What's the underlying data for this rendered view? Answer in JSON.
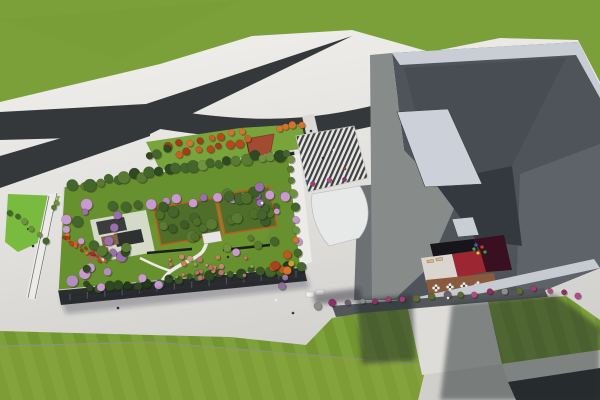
{
  "meta": {
    "type": "3d-architectural-aerial-rendering",
    "subject": "Aerial render of a campus: rooftop garden building, angular gray main building with sunken red courtyard terrace, forked asphalt roads, striped entrance plaza and striped lawns",
    "width": 600,
    "height": 400
  },
  "palette": {
    "pavement_light": "#f2f1ee",
    "pavement_dark": "#d3d2cf",
    "road_asphalt": "#35383a",
    "asphalt_dark": "#2a2d2f",
    "lawn_top": "#7ba03a",
    "lawn_stripe_a": "#7ea23a",
    "lawn_stripe_b": "#739631",
    "lawn_lower_tint": "#8ba33c",
    "bright_lawn": "#78bb3e",
    "garden_lawn": "#67902e",
    "north_strip_green": "#79a43c",
    "terracotta_plaza": "#a34a33",
    "corten_edge": "#c05a20",
    "building_parapet_light": "#c9cdd6",
    "building_wall_mid": "#878b8a",
    "building_wall_dark": "#4f545b",
    "building_fold": "#484d53",
    "building_overhang": "#343940",
    "skylight": "#ccd0d8",
    "courtyard_red": "#9c2732",
    "courtyard_maroon": "#381020",
    "deck_brown": "#8a5a3c",
    "shrub_magenta": "#a23a78",
    "blossom_purple": "#9b6fae",
    "autumn_orange": "#c2561f",
    "path_white": "#eceae6",
    "shadow": "#23282c"
  },
  "scene": {
    "vegetation": [
      {
        "name": "north-autumn-row-1",
        "layer": "back",
        "mode": "row",
        "a": [
          168,
          146
        ],
        "b": [
          244,
          131
        ],
        "count": 8,
        "rmin": 3,
        "rmax": 4.5,
        "jitter": 2,
        "colors": [
          "#b5491d",
          "#c95f24",
          "#a8391a",
          "#d2742d"
        ]
      },
      {
        "name": "north-autumn-row-2",
        "layer": "back",
        "mode": "row",
        "a": [
          178,
          155
        ],
        "b": [
          250,
          140
        ],
        "count": 8,
        "rmin": 3,
        "rmax": 4.5,
        "jitter": 2,
        "colors": [
          "#b5491d",
          "#c95f24",
          "#a8391a",
          "#d2742d"
        ]
      },
      {
        "name": "north-green-trees",
        "layer": "back",
        "mode": "row",
        "a": [
          148,
          156
        ],
        "b": [
          166,
          149
        ],
        "count": 3,
        "rmin": 3.5,
        "rmax": 5,
        "jitter": 1.5,
        "colors": [
          "#44662c",
          "#5a7a33",
          "#2f4a22"
        ]
      },
      {
        "name": "triangle-east-trees",
        "layer": "back",
        "mode": "row",
        "a": [
          278,
          129
        ],
        "b": [
          300,
          124
        ],
        "count": 4,
        "rmin": 2.8,
        "rmax": 4,
        "jitter": 1.5,
        "colors": [
          "#c2561f",
          "#aa2f18",
          "#d2742d",
          "#44662c"
        ]
      },
      {
        "name": "garden-north-perimeter-trees",
        "layer": "back",
        "mode": "row",
        "a": [
          74,
          186
        ],
        "b": [
          288,
          152
        ],
        "count": 26,
        "rmin": 3.5,
        "rmax": 6.5,
        "jitter": 3,
        "colors": [
          "#2f4a22",
          "#44662c",
          "#5a7a33",
          "#6f9140",
          "#44662c",
          "#2f4a22"
        ]
      },
      {
        "name": "garden-blossom-row",
        "layer": "back",
        "mode": "row",
        "a": [
          112,
          206
        ],
        "b": [
          284,
          194
        ],
        "count": 14,
        "rmin": 3.5,
        "rmax": 5.5,
        "jitter": 3,
        "colors": [
          "#9b6fae",
          "#b48cc2",
          "#c99ad0",
          "#44662c"
        ]
      },
      {
        "name": "garden-west-grove",
        "layer": "back",
        "mode": "scatter",
        "rect": [
          64,
          196,
          40,
          90
        ],
        "count": 13,
        "rmin": 3,
        "rmax": 6,
        "jitter": 0,
        "colors": [
          "#9b6fae",
          "#b48cc2",
          "#2f4a22",
          "#44662c",
          "#c99ad0",
          "#5a7a33"
        ]
      },
      {
        "name": "pavilion-trees",
        "layer": "back",
        "mode": "scatter",
        "rect": [
          92,
          212,
          54,
          46
        ],
        "count": 9,
        "rmin": 3,
        "rmax": 5.5,
        "jitter": 0,
        "colors": [
          "#2f4a22",
          "#44662c",
          "#5a7a33",
          "#9b6fae"
        ]
      },
      {
        "name": "grove-a-trees",
        "layer": "back",
        "mode": "scatter",
        "rect": [
          158,
          202,
          54,
          38
        ],
        "count": 12,
        "rmin": 4,
        "rmax": 6,
        "jitter": 0,
        "colors": [
          "#4f7029",
          "#5a7a33",
          "#44662c",
          "#3d5c26"
        ]
      },
      {
        "name": "grove-b-trees",
        "layer": "back",
        "mode": "scatter",
        "rect": [
          220,
          191,
          52,
          38
        ],
        "count": 12,
        "rmin": 4,
        "rmax": 6,
        "jitter": 0,
        "colors": [
          "#4f7029",
          "#5a7a33",
          "#44662c",
          "#3d5c26"
        ]
      },
      {
        "name": "garden-south-hedge",
        "layer": "back",
        "mode": "row",
        "a": [
          88,
          290
        ],
        "b": [
          300,
          267
        ],
        "count": 22,
        "rmin": 3,
        "rmax": 5.5,
        "jitter": 2.5,
        "colors": [
          "#243a1a",
          "#2f4a22",
          "#3c5a26",
          "#44662c"
        ]
      },
      {
        "name": "garden-east-row",
        "layer": "back",
        "mode": "row",
        "a": [
          290,
          158
        ],
        "b": [
          300,
          254
        ],
        "count": 9,
        "rmin": 3,
        "rmax": 5,
        "jitter": 2,
        "colors": [
          "#44662c",
          "#5a7a33",
          "#c99ad0",
          "#2f4a22",
          "#6f9140"
        ]
      },
      {
        "name": "garden-lawn-singles",
        "layer": "back",
        "mode": "scatter",
        "rect": [
          162,
          238,
          115,
          18
        ],
        "count": 5,
        "rmin": 3,
        "rmax": 5,
        "jitter": 0,
        "colors": [
          "#5a7a33",
          "#c2561f",
          "#c99ad0",
          "#44662c",
          "#6f9140"
        ]
      },
      {
        "name": "autumn-east-grove",
        "layer": "back",
        "mode": "scatter",
        "rect": [
          272,
          240,
          26,
          36
        ],
        "count": 7,
        "rmin": 3,
        "rmax": 5,
        "jitter": 0,
        "colors": [
          "#c2561f",
          "#a8431c",
          "#d2742d",
          "#c9a032",
          "#aa2f18"
        ]
      },
      {
        "name": "flower-drift-west",
        "layer": "back",
        "mode": "row",
        "a": [
          64,
          234
        ],
        "b": [
          104,
          262
        ],
        "count": 18,
        "rmin": 1.2,
        "rmax": 2.2,
        "jitter": 3.5,
        "colors": [
          "#c2401f",
          "#d4622a",
          "#b5331a",
          "#dd7a33"
        ]
      },
      {
        "name": "rose-shrub-drift",
        "layer": "back",
        "mode": "scatter",
        "rect": [
          166,
          256,
          90,
          22
        ],
        "count": 24,
        "rmin": 1.5,
        "rmax": 3,
        "jitter": 0,
        "colors": [
          "#c28a6e",
          "#cc9a80",
          "#b5766a",
          "#8fa05a",
          "#c97f5c"
        ]
      },
      {
        "name": "south-blossom-trees",
        "layer": "back",
        "mode": "scatter",
        "rect": [
          100,
          268,
          60,
          20
        ],
        "count": 4,
        "rmin": 3,
        "rmax": 4.5,
        "jitter": 0,
        "colors": [
          "#c99ad0",
          "#b48cc2"
        ]
      },
      {
        "name": "southeast-blossoms",
        "layer": "back",
        "mode": "scatter",
        "rect": [
          282,
          276,
          14,
          12
        ],
        "count": 2,
        "rmin": 3,
        "rmax": 4,
        "jitter": 0,
        "colors": [
          "#9b6fae",
          "#b48cc2"
        ]
      },
      {
        "name": "plaza-edge-blossoms",
        "layer": "back",
        "mode": "scatter",
        "rect": [
          252,
          186,
          36,
          32
        ],
        "count": 6,
        "rmin": 3,
        "rmax": 5,
        "jitter": 0,
        "colors": [
          "#9b6fae",
          "#b48cc2",
          "#44662c",
          "#c99ad0"
        ]
      },
      {
        "name": "plaza-south-shrubs",
        "layer": "back",
        "mode": "row",
        "a": [
          314,
          183
        ],
        "b": [
          344,
          179
        ],
        "count": 3,
        "rmin": 2,
        "rmax": 3,
        "jitter": 1,
        "colors": [
          "#a23a78",
          "#b14a85",
          "#8e2e67"
        ]
      },
      {
        "name": "west-sidewalk-bushes",
        "layer": "back",
        "mode": "row",
        "a": [
          10,
          212
        ],
        "b": [
          46,
          240
        ],
        "count": 6,
        "rmin": 2.5,
        "rmax": 3.5,
        "jitter": 2.5,
        "colors": [
          "#5a7a33",
          "#6f9140",
          "#44662c"
        ]
      },
      {
        "name": "west-corner-bushes",
        "layer": "back",
        "mode": "scatter",
        "rect": [
          46,
          198,
          16,
          12
        ],
        "count": 2,
        "rmin": 2.5,
        "rmax": 3.5,
        "jitter": 0,
        "colors": [
          "#5a7a33",
          "#6f9140"
        ]
      },
      {
        "name": "forecourt-shrub-row",
        "layer": "front",
        "mode": "row",
        "a": [
          318,
          305
        ],
        "b": [
          532,
          289
        ],
        "count": 16,
        "rmin": 2.5,
        "rmax": 4,
        "jitter": 1.5,
        "colors": [
          "#a23a78",
          "#8e2e67",
          "#b14a85",
          "#5f6a32",
          "#6b5f6b",
          "#8d8d8b"
        ]
      },
      {
        "name": "east-shrub-group",
        "layer": "front",
        "mode": "row",
        "a": [
          552,
          291
        ],
        "b": [
          578,
          295
        ],
        "count": 3,
        "rmin": 2.5,
        "rmax": 3.5,
        "jitter": 1,
        "colors": [
          "#a23a78",
          "#8e2e67",
          "#b14a85"
        ]
      }
    ],
    "people": [
      [
        323,
        158,
        "#2e3133"
      ],
      [
        334,
        150,
        "#ececea"
      ],
      [
        345,
        169,
        "#b03432"
      ],
      [
        307,
        181,
        "#3e5aa8"
      ],
      [
        311,
        131,
        "#2e3133"
      ],
      [
        170,
        277,
        "#2c2f31"
      ],
      [
        205,
        247,
        "#ededeb"
      ],
      [
        228,
        257,
        "#2c2f31"
      ],
      [
        276,
        300,
        "#ededeb"
      ],
      [
        293,
        313,
        "#34373a"
      ],
      [
        448,
        298,
        "#e9e9e7"
      ],
      [
        118,
        308,
        "#2c2f31"
      ],
      [
        33,
        246,
        "#2c2f31"
      ],
      [
        262,
        203,
        "#ededeb"
      ]
    ],
    "parasol_tables": [
      [
        436,
        288
      ],
      [
        450,
        287
      ],
      [
        464,
        286
      ],
      [
        478,
        285
      ],
      [
        497,
        286
      ]
    ],
    "playground_items": [
      [
        474,
        249,
        "#3fae3f"
      ],
      [
        478,
        253,
        "#e8c52c"
      ],
      [
        482,
        247,
        "#cf3b2a"
      ],
      [
        476,
        245,
        "#3e62c4"
      ],
      [
        485,
        252,
        "#37a04a"
      ]
    ],
    "facade_windows": {
      "count": 14,
      "x0": 70,
      "y0": 294,
      "x1": 296,
      "y1": 271,
      "h": 6.5,
      "color": "rgba(150,170,195,0.35)"
    }
  }
}
